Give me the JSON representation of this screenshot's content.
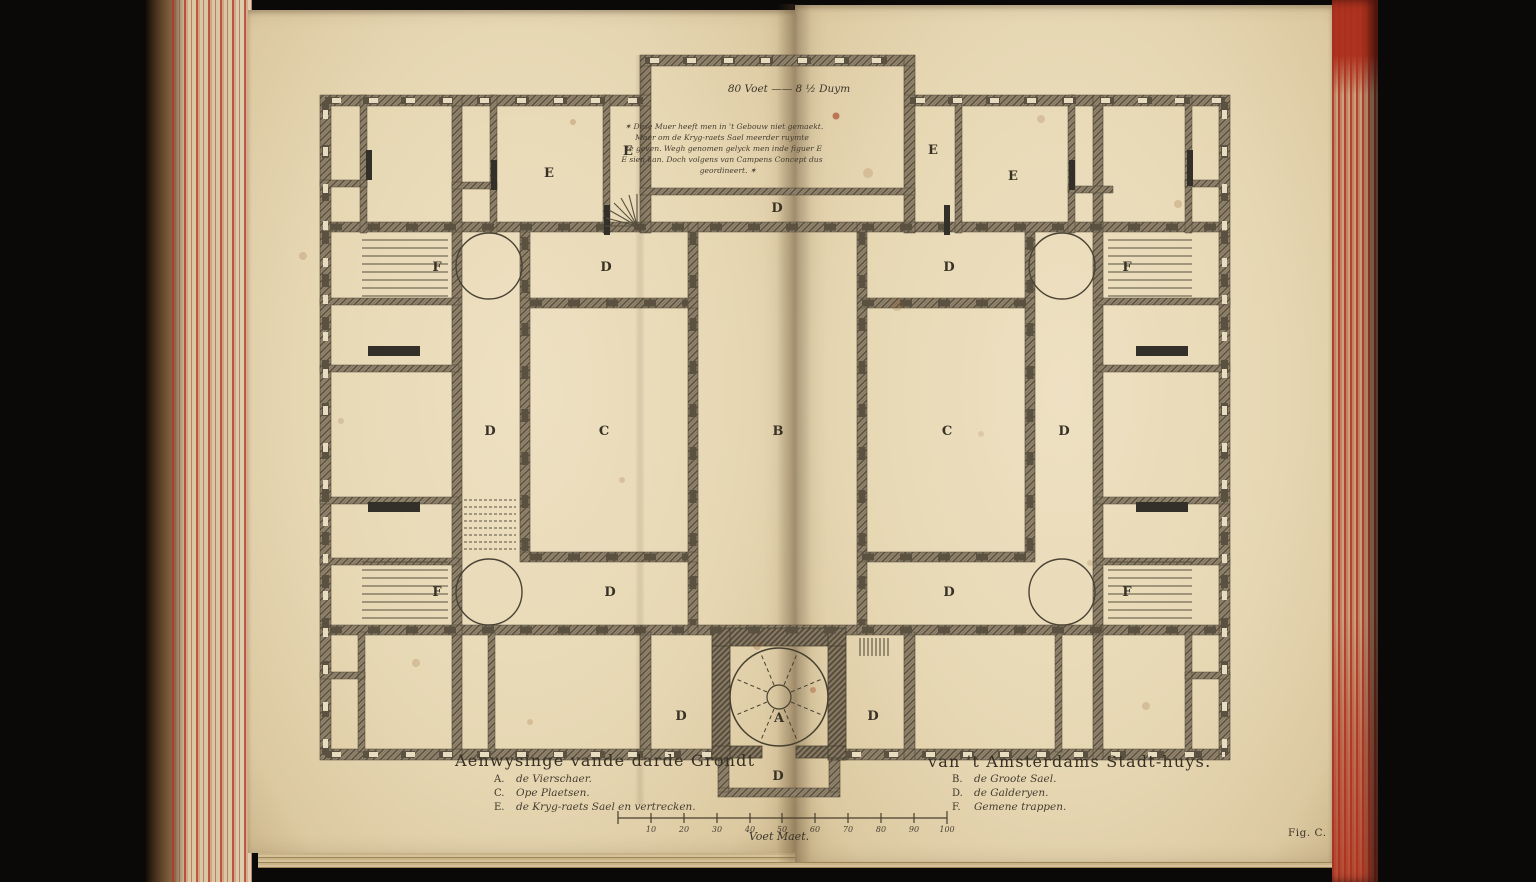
{
  "book": {
    "fig_label": "Fig. C.",
    "page_color": "#e7d8b4",
    "edge_red_color": "#b5371f",
    "ink_color": "#3c352a"
  },
  "plan": {
    "scale_note": "80 Voet —— 8 ½ Duym",
    "note_block": {
      "lines": [
        "✶ Dese Muer heeft men in 't Gebouw niet gemaekt.",
        "Maer om de Kryg-raets Sael meerder ruymte",
        "te geven. Wegh genomen gelyck men inde figuer E",
        "E sien kan. Doch volgens van Campens Concept dus",
        "geordineert. ✶"
      ]
    },
    "letters": [
      {
        "label": "E"
      },
      {
        "label": "E"
      },
      {
        "label": "E"
      },
      {
        "label": "E"
      },
      {
        "label": "D"
      },
      {
        "label": "D"
      },
      {
        "label": "D"
      },
      {
        "label": "F"
      },
      {
        "label": "F"
      },
      {
        "label": "D"
      },
      {
        "label": "C"
      },
      {
        "label": "B"
      },
      {
        "label": "C"
      },
      {
        "label": "D"
      },
      {
        "label": "F"
      },
      {
        "label": "F"
      },
      {
        "label": "D"
      },
      {
        "label": "D"
      },
      {
        "label": "D"
      },
      {
        "label": "A"
      },
      {
        "label": "D"
      },
      {
        "label": "D"
      }
    ],
    "legend_left": {
      "title": "Aenwysinge vande darde Grondt",
      "entries": [
        {
          "key": "A.",
          "text": "de Vierschaer."
        },
        {
          "key": "C.",
          "text": "Ope Plaetsen."
        },
        {
          "key": "E.",
          "text": "de Kryg-raets Sael en vertrecken."
        }
      ]
    },
    "legend_right": {
      "title": "van 't Amsterdams Stadt-huys.",
      "entries": [
        {
          "key": "B.",
          "text": "de Groote Sael."
        },
        {
          "key": "D.",
          "text": "de Galderyen."
        },
        {
          "key": "F.",
          "text": "Gemene trappen."
        }
      ]
    },
    "scale_bar": {
      "label": "Voet Maet.",
      "ticks": [
        "10",
        "20",
        "30",
        "40",
        "50",
        "60",
        "70",
        "80",
        "90",
        "100"
      ]
    }
  }
}
